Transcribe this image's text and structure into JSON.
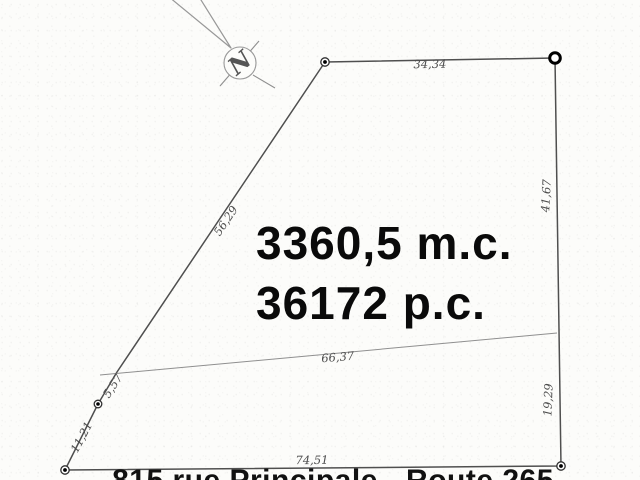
{
  "plan": {
    "type": "lot-survey-plan",
    "area_metric": "3360,5 m.c.",
    "area_imperial": "36172 p.c.",
    "address_caption": "815 rue Principale - Route 265",
    "north_symbol": "N",
    "dimensions": {
      "top": "34,34",
      "right_upper": "41,67",
      "right_lower": "19,29",
      "bottom": "74,51",
      "left_upper": "56,29",
      "left_middle": "5,57",
      "left_lower": "11,21",
      "interior": "66,37"
    },
    "colors": {
      "background": "#fcfcfa",
      "boundary_line": "#4f4f4f",
      "thin_line": "#8f8f8f",
      "label_ink": "#4d4d4d",
      "area_ink": "#0a0a0a"
    }
  }
}
